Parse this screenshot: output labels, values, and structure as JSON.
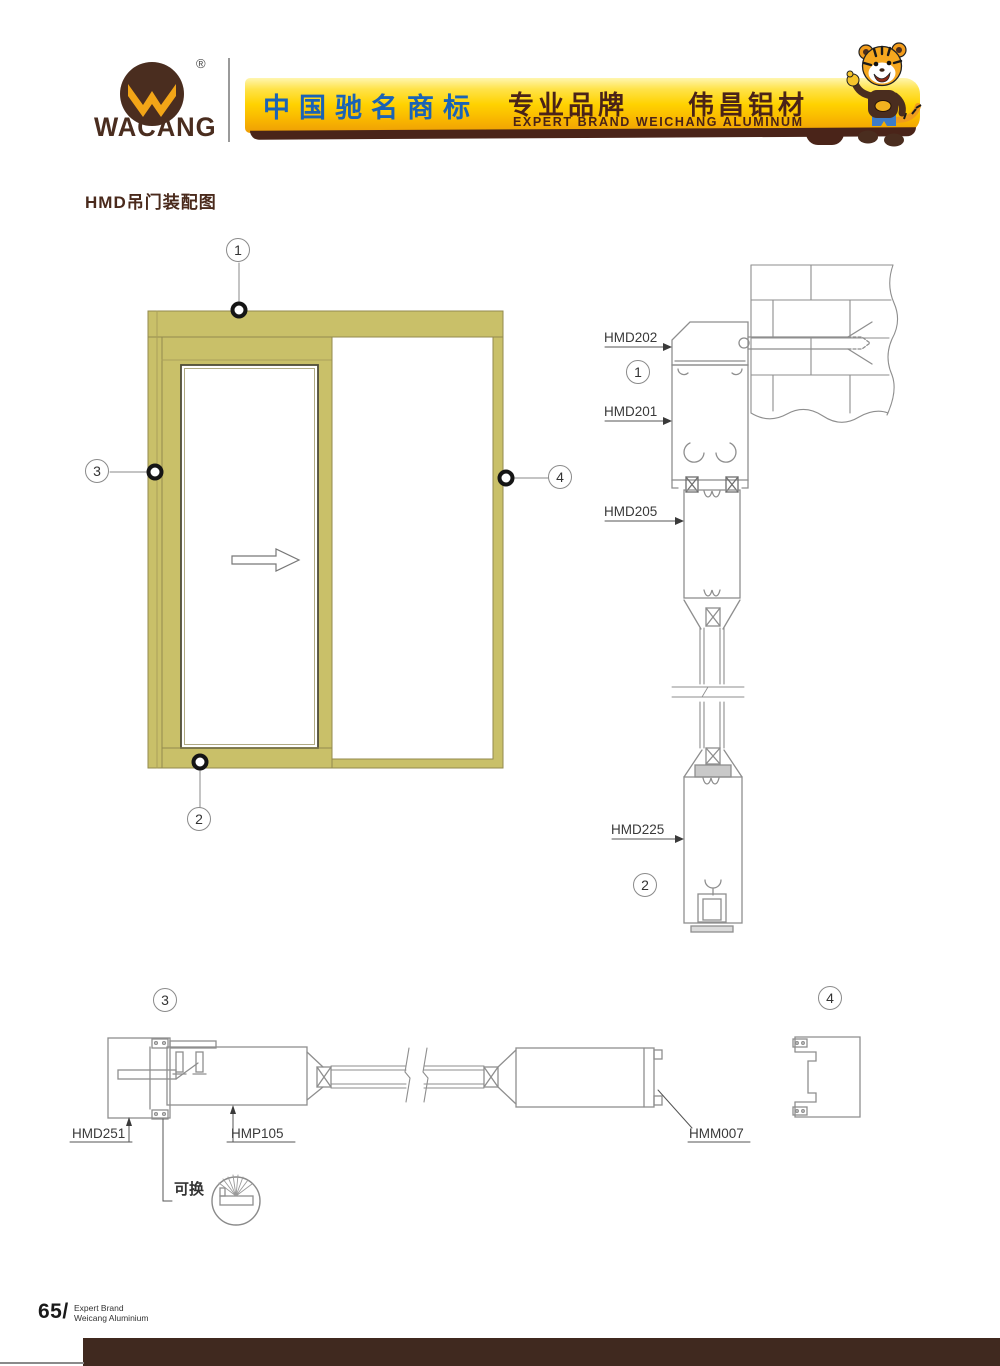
{
  "header": {
    "brand": "WACANG",
    "registered": "®",
    "banner_left": "中国驰名商标",
    "banner_right_cn": "专业品牌　　伟昌铝材",
    "banner_right_en": "EXPERT BRAND WEICHANG ALUMINUM",
    "colors": {
      "banner_gold": "#ffd200",
      "banner_shadow": "#4a2419",
      "blue_text": "#1b63b5",
      "brown_text": "#4a2318"
    }
  },
  "title": "HMD吊门装配图",
  "callouts": {
    "c1": "1",
    "c2": "2",
    "c3": "3",
    "c4": "4"
  },
  "profiles": {
    "hmd202": "HMD202",
    "hmd201": "HMD201",
    "hmd205": "HMD205",
    "hmd225": "HMD225",
    "hmd251": "HMD251",
    "hmp105": "HMP105",
    "hmm007": "HMM007"
  },
  "notes": {
    "replaceable": "可换"
  },
  "elevation": {
    "frame_color": "#c9c069",
    "slide_direction": "right"
  },
  "footer": {
    "page_number": "65/",
    "tagline_line1": "Expert Brand",
    "tagline_line2": "Weicang Aluminium",
    "bar_color": "#40291f"
  }
}
